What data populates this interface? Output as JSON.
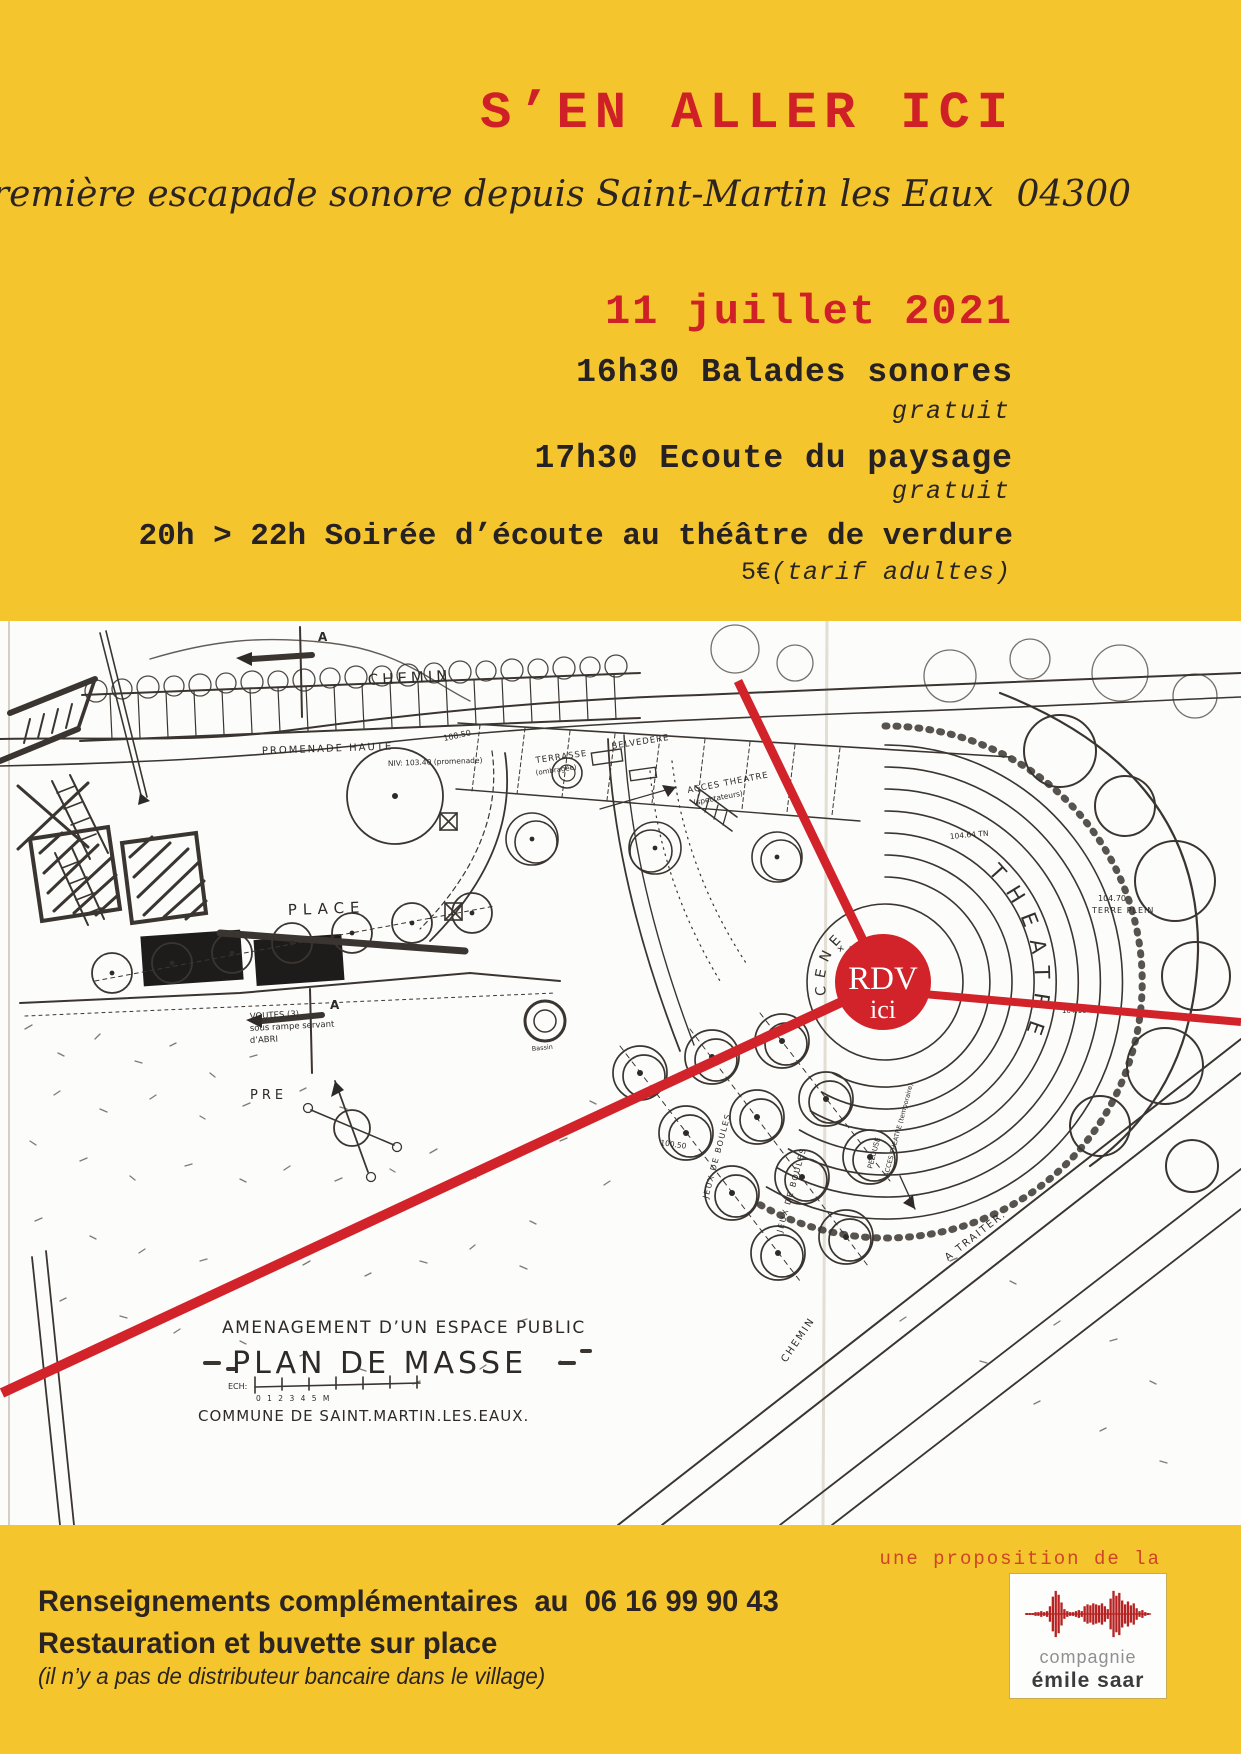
{
  "colors": {
    "yellow": "#f5c52d",
    "red": "#d2232a",
    "red_orange": "#cd4526",
    "ink": "#2e2a27"
  },
  "header": {
    "title": "S’EN ALLER ICI",
    "subtitle": "première escapade sonore depuis Saint-Martin les Eaux  04300",
    "date": "11 juillet 2021"
  },
  "schedule": {
    "items": [
      {
        "label": "16h30 Balades sonores",
        "note": "gratuit"
      },
      {
        "label": "17h30 Ecoute du paysage",
        "note": "gratuit"
      },
      {
        "label": "20h > 22h Soirée d’écoute au théâtre de verdure",
        "price": "5€",
        "note": "(tarif adultes)"
      }
    ]
  },
  "map": {
    "rdv": {
      "line1": "RDV",
      "line2": "ici"
    },
    "labels": {
      "chemin_top": "CHEMIN",
      "promenade": "PROMENADE HAUTE",
      "promenade_niv": "NIV: 103.40 (promenade)",
      "terrasse": "TERRASSE",
      "terrasse2": "(ombragée)",
      "belvedere": "BELVEDERE",
      "acces_theatre": "ACCES THEATRE",
      "acces_theatre2": "(spectateurs)",
      "voutes1": "VOUTES (3)",
      "voutes2": "sous rampe servant",
      "voutes3": "d’ABRI",
      "theatre": "THEATRE",
      "scene": "SCENE",
      "place": "PLACE",
      "pre": "PRE",
      "jeux": "JEUX DE BOULES",
      "pelouse": "PELOUSE",
      "acces_temp": "ACCES THEATRE (temporaire)",
      "chemin_bottom": "CHEMIN",
      "a_traiter": "A TRAITER.",
      "north_mark": "A",
      "bassin": "Bassin"
    },
    "elevations": {
      "stage": "+ 101.50",
      "terre_plein1": "104.70",
      "terre_plein2": "TERRE PLEIN",
      "tn": "104.64 TN",
      "tn2": "104.16 TN",
      "promenade": "108.50",
      "place": "100.50"
    },
    "title_block": {
      "line1": "AMENAGEMENT D’UN ESPACE PUBLIC",
      "line2": "PLAN DE MASSE",
      "ech": "ECH:",
      "scale": "0 1 2 3 4 5 M",
      "line3": "COMMUNE DE SAINT.MARTIN.LES.EAUX."
    }
  },
  "footer": {
    "proposition": "une proposition de la",
    "logo": {
      "line1": "compagnie",
      "line2": "émile saar"
    },
    "info_line1": "Renseignements complémentaires  au  06 16 99 90 43",
    "info_line2": "Restauration et buvette sur place",
    "info_line3": "(il n’y a pas de distributeur bancaire dans le village)"
  }
}
